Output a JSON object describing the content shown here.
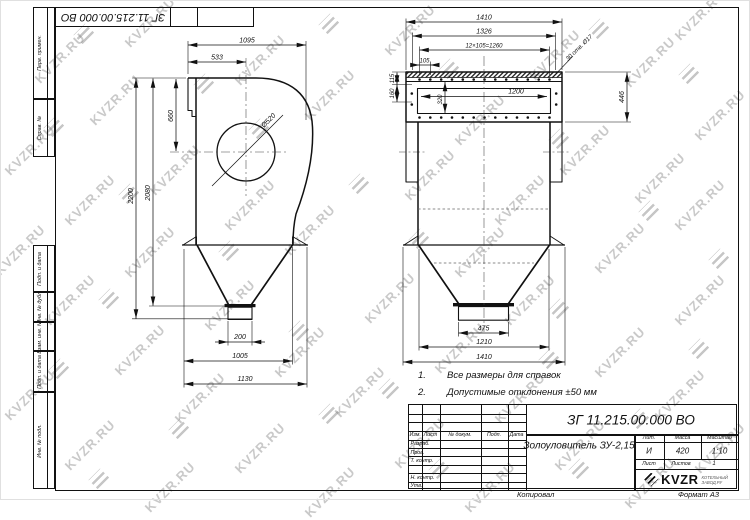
{
  "watermark": {
    "text": "KVZR.RU",
    "text_positions": [
      [
        150,
        22
      ],
      [
        410,
        30
      ],
      [
        700,
        15
      ],
      [
        60,
        58
      ],
      [
        260,
        60
      ],
      [
        555,
        55
      ],
      [
        650,
        62
      ],
      [
        115,
        100
      ],
      [
        330,
        95
      ],
      [
        480,
        120
      ],
      [
        720,
        115
      ],
      [
        30,
        150
      ],
      [
        175,
        170
      ],
      [
        430,
        175
      ],
      [
        585,
        150
      ],
      [
        660,
        178
      ],
      [
        90,
        200
      ],
      [
        250,
        205
      ],
      [
        520,
        200
      ],
      [
        700,
        205
      ],
      [
        20,
        250
      ],
      [
        150,
        252
      ],
      [
        310,
        230
      ],
      [
        480,
        252
      ],
      [
        620,
        248
      ],
      [
        70,
        300
      ],
      [
        230,
        305
      ],
      [
        390,
        298
      ],
      [
        530,
        300
      ],
      [
        700,
        300
      ],
      [
        140,
        350
      ],
      [
        300,
        352
      ],
      [
        460,
        348
      ],
      [
        620,
        352
      ],
      [
        30,
        395
      ],
      [
        200,
        398
      ],
      [
        360,
        392
      ],
      [
        520,
        398
      ],
      [
        680,
        395
      ],
      [
        90,
        445
      ],
      [
        260,
        448
      ],
      [
        420,
        443
      ],
      [
        580,
        445
      ],
      [
        720,
        448
      ],
      [
        170,
        487
      ],
      [
        330,
        492
      ],
      [
        490,
        487
      ],
      [
        650,
        483
      ]
    ],
    "logo_positions": [
      [
        85,
        35
      ],
      [
        330,
        25
      ],
      [
        600,
        30
      ],
      [
        205,
        85
      ],
      [
        450,
        70
      ],
      [
        690,
        75
      ],
      [
        55,
        128
      ],
      [
        260,
        130
      ],
      [
        560,
        140
      ],
      [
        130,
        195
      ],
      [
        360,
        185
      ],
      [
        650,
        212
      ],
      [
        230,
        252
      ],
      [
        420,
        240
      ],
      [
        720,
        260
      ],
      [
        110,
        300
      ],
      [
        300,
        332
      ],
      [
        560,
        310
      ],
      [
        60,
        370
      ],
      [
        390,
        390
      ],
      [
        550,
        360
      ],
      [
        700,
        350
      ],
      [
        180,
        430
      ],
      [
        330,
        415
      ],
      [
        640,
        420
      ],
      [
        100,
        480
      ],
      [
        440,
        470
      ],
      [
        580,
        470
      ]
    ]
  },
  "stamp_top": {
    "doc_number": "ЗГ 11.215.00.000 ВО"
  },
  "margin_labels": {
    "perv": "Перв. примен.",
    "sprav": "Справ. №",
    "podp1": "Подп. и дата",
    "inv_dubl": "Инв. № дубл.",
    "vzam": "Взам. инв. №",
    "podp2": "Подп. и дата",
    "inv_podl": "Инв. № подл."
  },
  "drawing": {
    "left_view_dims": {
      "top_width": "1095",
      "inlet_width": "533",
      "inlet_height": "660",
      "scroll_diameter": "Ø520",
      "height_total": "2200",
      "height_inner": "2080",
      "outlet_width": "200",
      "bottom_width": "1005",
      "base_width": "1130"
    },
    "right_view_dims": {
      "flange_width": "1410",
      "flange_width_inner": "1326",
      "holes_pitch": "12×105=1260",
      "hole_offset": "105",
      "edge_offset": "115",
      "row_spacing": "160",
      "opening_height": "320",
      "opening_width": "1200",
      "flange_height": "446",
      "holes_note": "30 отв. Ø17",
      "outlet_width": "475",
      "hopper_width": "1210",
      "base_width": "1410"
    }
  },
  "notes": {
    "n1_num": "1.",
    "n1_text": "Все размеры для справок",
    "n2_num": "2.",
    "n2_text": "Допустимые отклонения  ±50 мм"
  },
  "title_block": {
    "doc_number": "ЗГ 11.215.00.000  ВО",
    "name": "Золоуловитель ЗУ-2,15",
    "header": {
      "izm": "Изм.",
      "list": "Лист",
      "doc": "№ докум.",
      "podp": "Подп.",
      "data": "Дата"
    },
    "rows": {
      "razrab": "Разраб.",
      "prov": "Пров.",
      "t_kontr": "Т. контр.",
      "n_kontr": "Н. контр.",
      "utv": "Утв."
    },
    "lit": {
      "label": "Лит.",
      "value": "И"
    },
    "mass": {
      "label": "Масса",
      "value": "420"
    },
    "scale": {
      "label": "Масштаб",
      "value": "1:10"
    },
    "sheet": {
      "label": "Лист",
      "sheets_label": "Листов",
      "sheets_value": "1"
    },
    "logo": {
      "text": "KVZR",
      "sub1": "КОТЕЛЬНЫЙ",
      "sub2": "ЗАВОД.РУ"
    },
    "footer": {
      "copy": "Копировал",
      "format": "Формат А3"
    }
  }
}
